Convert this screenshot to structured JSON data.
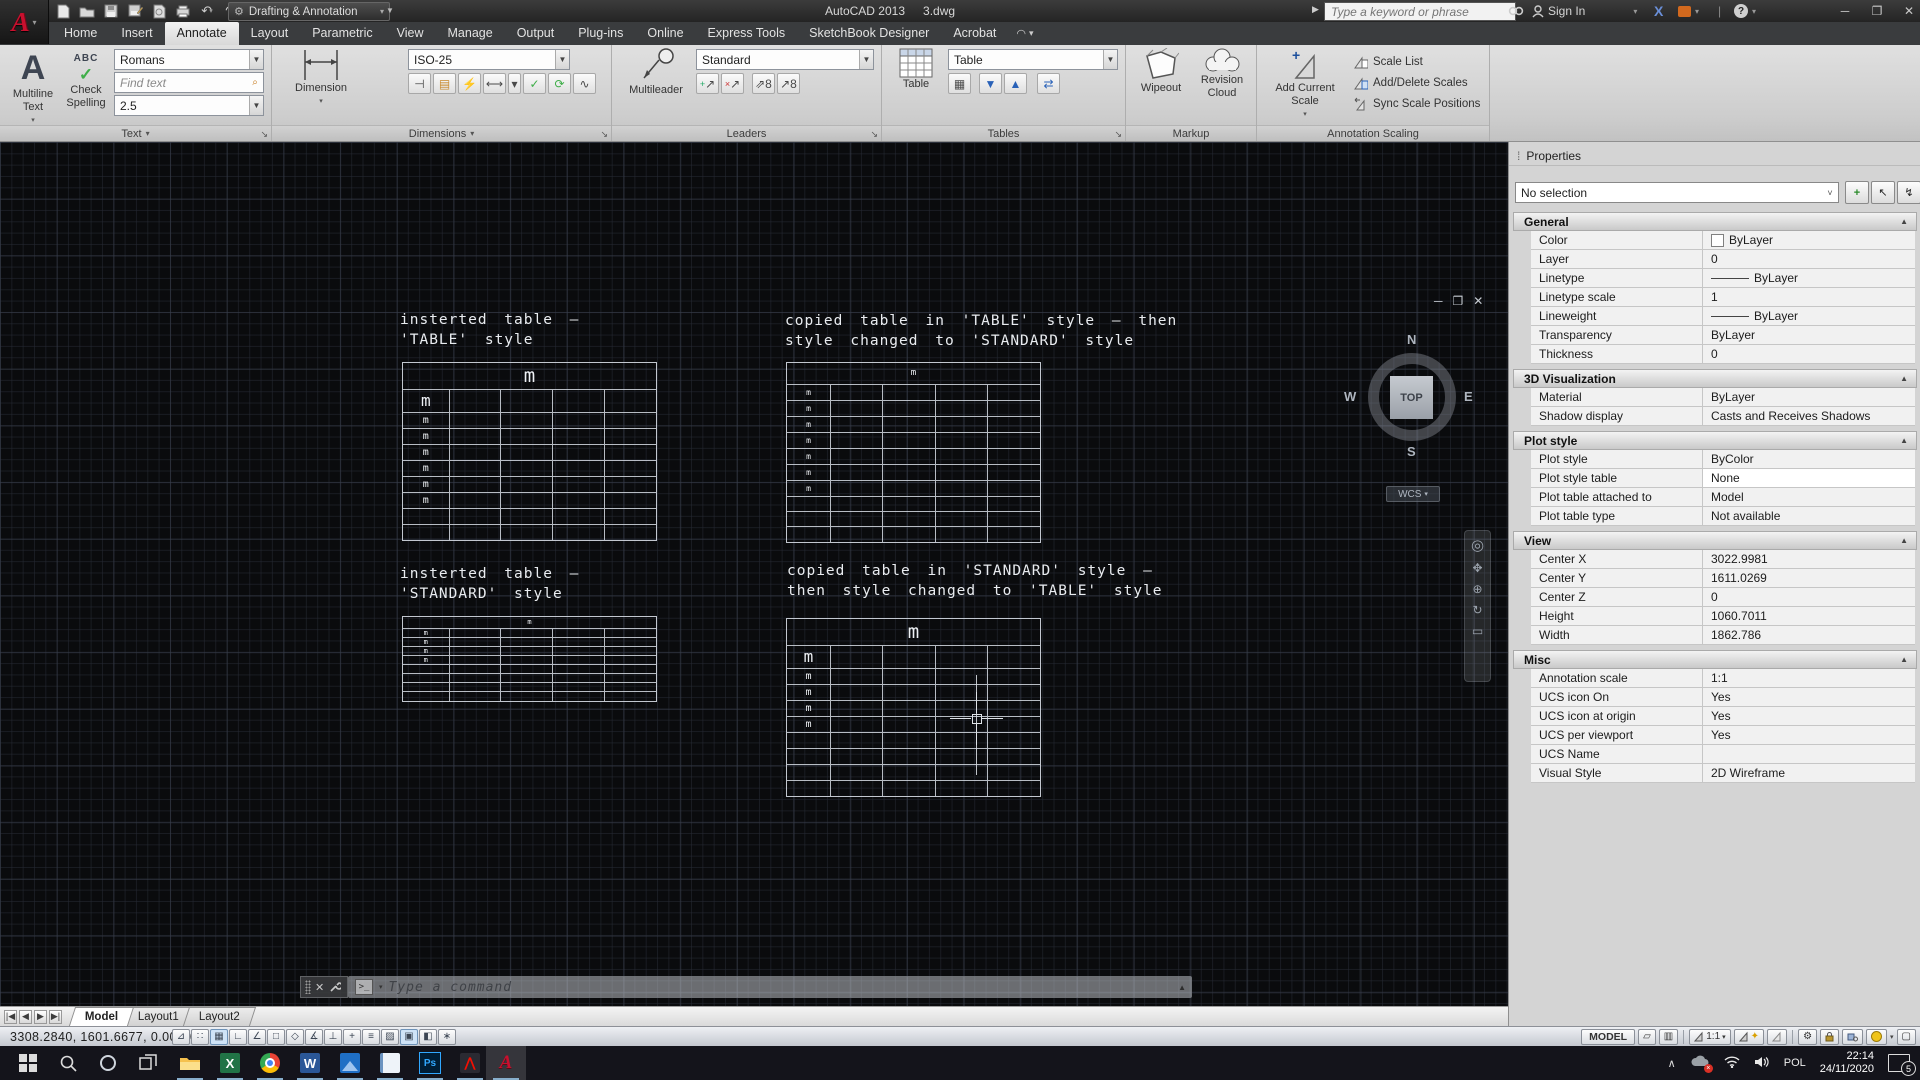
{
  "title_bar": {
    "workspace": "Drafting & Annotation",
    "app_title": "AutoCAD 2013",
    "doc_name": "3.dwg",
    "search_placeholder": "Type a keyword or phrase",
    "sign_in_label": "Sign In"
  },
  "ribbon": {
    "tabs": [
      {
        "label": "Home"
      },
      {
        "label": "Insert"
      },
      {
        "label": "Annotate",
        "active": true
      },
      {
        "label": "Layout"
      },
      {
        "label": "Parametric"
      },
      {
        "label": "View"
      },
      {
        "label": "Manage"
      },
      {
        "label": "Output"
      },
      {
        "label": "Plug-ins"
      },
      {
        "label": "Online"
      },
      {
        "label": "Express Tools"
      },
      {
        "label": "SketchBook Designer"
      },
      {
        "label": "Acrobat"
      }
    ],
    "panels": {
      "text": {
        "title": "Text",
        "multiline_label": "Multiline Text",
        "check_label": "Check Spelling",
        "abc": "ABC",
        "style_value": "Romans",
        "find_placeholder": "Find text",
        "height_value": "2.5"
      },
      "dimensions": {
        "title": "Dimensions",
        "button_label": "Dimension",
        "style_value": "ISO-25"
      },
      "leaders": {
        "title": "Leaders",
        "button_label": "Multileader",
        "style_value": "Standard"
      },
      "tables": {
        "title": "Tables",
        "button_label": "Table",
        "style_value": "Table"
      },
      "markup": {
        "title": "Markup",
        "wipeout_label": "Wipeout",
        "revcloud_label": "Revision Cloud"
      },
      "annotation_scaling": {
        "title": "Annotation Scaling",
        "add_label": "Add Current Scale",
        "items": [
          "Scale List",
          "Add/Delete Scales",
          "Sync Scale Positions"
        ]
      }
    }
  },
  "canvas": {
    "labels": [
      {
        "lines": [
          "insterted table –",
          "'TABLE' style"
        ]
      },
      {
        "lines": [
          "copied table in 'TABLE' style – then",
          "style changed to 'STANDARD' style"
        ]
      },
      {
        "lines": [
          "insterted table –",
          "'STANDARD' style"
        ]
      },
      {
        "lines": [
          "copied table in 'STANDARD' style –",
          "then style changed to 'TABLE' style"
        ]
      }
    ],
    "tables": [
      {
        "name": "inserted-table-table-style",
        "cell_text": "m"
      },
      {
        "name": "copied-table-standard-style",
        "cell_text": "m"
      },
      {
        "name": "inserted-table-standard-style",
        "cell_text": "m"
      },
      {
        "name": "copied-table-table-style",
        "cell_text": "m"
      }
    ],
    "viewcube": {
      "north": "N",
      "west": "W",
      "east": "E",
      "south": "S",
      "face": "TOP",
      "wcs_label": "WCS"
    },
    "ucs": {
      "x_label": "X",
      "y_label": "Y"
    }
  },
  "command_line": {
    "placeholder": "Type a command"
  },
  "layout_bar": {
    "tabs": [
      {
        "label": "Model",
        "active": true
      },
      {
        "label": "Layout1"
      },
      {
        "label": "Layout2"
      }
    ]
  },
  "status_bar": {
    "coords": "3308.2840, 1601.6677, 0.0000",
    "toggles": [
      {
        "name": "infer-constraints",
        "glyph": "⊿"
      },
      {
        "name": "snap-mode",
        "glyph": "∷"
      },
      {
        "name": "grid-display",
        "glyph": "▦",
        "pressed": true
      },
      {
        "name": "ortho-mode",
        "glyph": "∟"
      },
      {
        "name": "polar-tracking",
        "glyph": "∠"
      },
      {
        "name": "object-snap",
        "glyph": "□"
      },
      {
        "name": "object-snap-3d",
        "glyph": "◇"
      },
      {
        "name": "object-snap-tracking",
        "glyph": "∡"
      },
      {
        "name": "dynamic-ucs",
        "glyph": "⊥"
      },
      {
        "name": "dynamic-input",
        "glyph": "+"
      },
      {
        "name": "lineweight",
        "glyph": "≡"
      },
      {
        "name": "transparency",
        "glyph": "▨"
      },
      {
        "name": "quick-properties",
        "glyph": "▣",
        "pressed": true
      },
      {
        "name": "selection-cycling",
        "glyph": "◧"
      },
      {
        "name": "annotation-monitor",
        "glyph": "∗"
      }
    ],
    "model_button": "MODEL",
    "annotation_scale": "1:1"
  },
  "properties_palette": {
    "title": "Properties",
    "selection": "No selection",
    "sections": [
      {
        "name": "General",
        "rows": [
          {
            "label": "Color",
            "value": "ByLayer",
            "swatch": true
          },
          {
            "label": "Layer",
            "value": "0"
          },
          {
            "label": "Linetype",
            "value": "ByLayer",
            "line": true
          },
          {
            "label": "Linetype scale",
            "value": "1"
          },
          {
            "label": "Lineweight",
            "value": "ByLayer",
            "line": true
          },
          {
            "label": "Transparency",
            "value": "ByLayer"
          },
          {
            "label": "Thickness",
            "value": "0"
          }
        ]
      },
      {
        "name": "3D Visualization",
        "rows": [
          {
            "label": "Material",
            "value": "ByLayer"
          },
          {
            "label": "Shadow display",
            "value": "Casts and Receives Shadows"
          }
        ]
      },
      {
        "name": "Plot style",
        "rows": [
          {
            "label": "Plot style",
            "value": "ByColor"
          },
          {
            "label": "Plot style table",
            "value": "None",
            "selected": true
          },
          {
            "label": "Plot table attached to",
            "value": "Model"
          },
          {
            "label": "Plot table type",
            "value": "Not available"
          }
        ]
      },
      {
        "name": "View",
        "rows": [
          {
            "label": "Center X",
            "value": "3022.9981"
          },
          {
            "label": "Center Y",
            "value": "1611.0269"
          },
          {
            "label": "Center Z",
            "value": "0"
          },
          {
            "label": "Height",
            "value": "1060.7011"
          },
          {
            "label": "Width",
            "value": "1862.786"
          }
        ]
      },
      {
        "name": "Misc",
        "rows": [
          {
            "label": "Annotation scale",
            "value": "1:1"
          },
          {
            "label": "UCS icon On",
            "value": "Yes"
          },
          {
            "label": "UCS icon at origin",
            "value": "Yes"
          },
          {
            "label": "UCS per viewport",
            "value": "Yes"
          },
          {
            "label": "UCS Name",
            "value": ""
          },
          {
            "label": "Visual Style",
            "value": "2D Wireframe"
          }
        ]
      }
    ]
  },
  "taskbar": {
    "apps": [
      {
        "name": "start"
      },
      {
        "name": "search"
      },
      {
        "name": "cortana"
      },
      {
        "name": "task-view"
      },
      {
        "name": "file-explorer",
        "running": true
      },
      {
        "name": "excel",
        "running": true
      },
      {
        "name": "chrome",
        "running": true
      },
      {
        "name": "word",
        "running": true
      },
      {
        "name": "photos",
        "running": true
      },
      {
        "name": "notepad",
        "running": true
      },
      {
        "name": "photoshop",
        "running": true
      },
      {
        "name": "acrobat",
        "running": true
      },
      {
        "name": "autocad",
        "running": true,
        "active": true
      }
    ],
    "tray": {
      "lang": "POL",
      "time": "22:14",
      "date": "24/11/2020",
      "notification_count": "5"
    }
  }
}
